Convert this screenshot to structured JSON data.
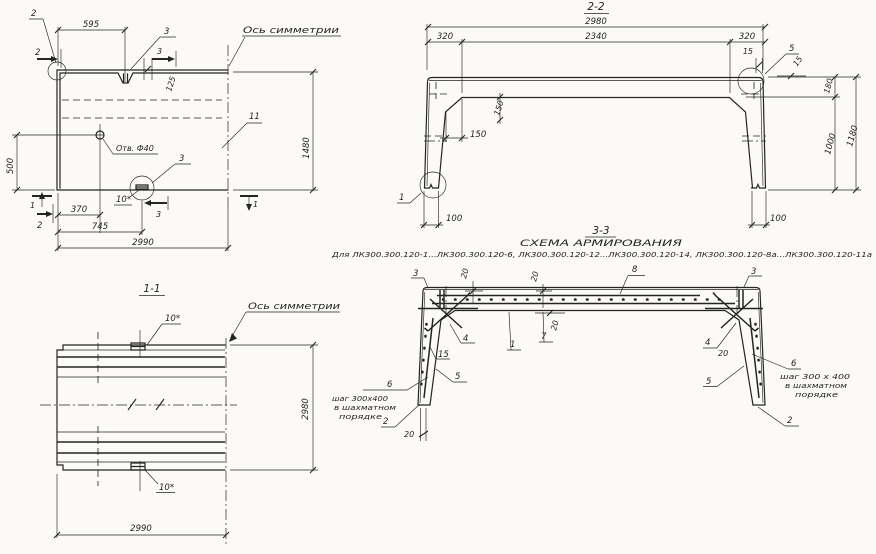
{
  "theme": {
    "bg": "#fbfaf7",
    "ink": "#242424"
  },
  "plan": {
    "axis_label": "Ось симметрии",
    "hole_label": "Отв. Ф40",
    "label_11": "11",
    "label_10star": "10*",
    "mark2_top": "2",
    "mark2_side": "2",
    "mark2_bottom": "2",
    "mark1_left": "1",
    "mark1_right": "1",
    "mark3_top_label": "3",
    "mark3_top_mark": "3",
    "mark3_bottom_label": "3",
    "mark3_bottom_mark": "3",
    "dim_595": "595",
    "dim_125": "125",
    "dim_1480": "1480",
    "dim_500": "500",
    "dim_370": "370",
    "dim_745": "745",
    "dim_2990": "2990"
  },
  "section22": {
    "title": "2-2",
    "dim_2980": "2980",
    "dim_320_left": "320",
    "dim_2340": "2340",
    "dim_320_right": "320",
    "dim_15_top": "15",
    "dim_15_side": "15",
    "label_5": "5",
    "dim_180": "180",
    "dim_1000": "1000",
    "dim_1180": "1180",
    "dim_150_vert": "150",
    "dim_150_horiz": "150",
    "dim_100_left": "100",
    "dim_100_right": "100",
    "label_1": "1"
  },
  "view11": {
    "title": "1-1",
    "axis_label": "Ось симметрии",
    "label_10star_top": "10*",
    "label_10star_bottom": "10*",
    "dim_2980": "2980",
    "dim_2990": "2990"
  },
  "section33": {
    "title": "3-3",
    "subtitle": "СХЕМА АРМИРОВАНИЯ",
    "applies_to": "Для ЛК300.300.120-1...ЛК300.300.120-6, ЛК300.300.120-12...ЛК300.300.120-14, ЛК300.300.120-8а...ЛК300.300.120-11а",
    "bar_labels": {
      "b1": "1",
      "b2": "2",
      "b3": "3",
      "b4": "4",
      "b5": "5",
      "b6": "6",
      "b7": "7",
      "b8": "8",
      "b15": "15",
      "b20": "20"
    },
    "note": {
      "line1": "шаг 300х400",
      "line2": "в шахматном",
      "line3": "порядке"
    },
    "note_right": {
      "line1": "шаг 300 х 400",
      "line2": "в шахматном",
      "line3": "порядке"
    }
  }
}
